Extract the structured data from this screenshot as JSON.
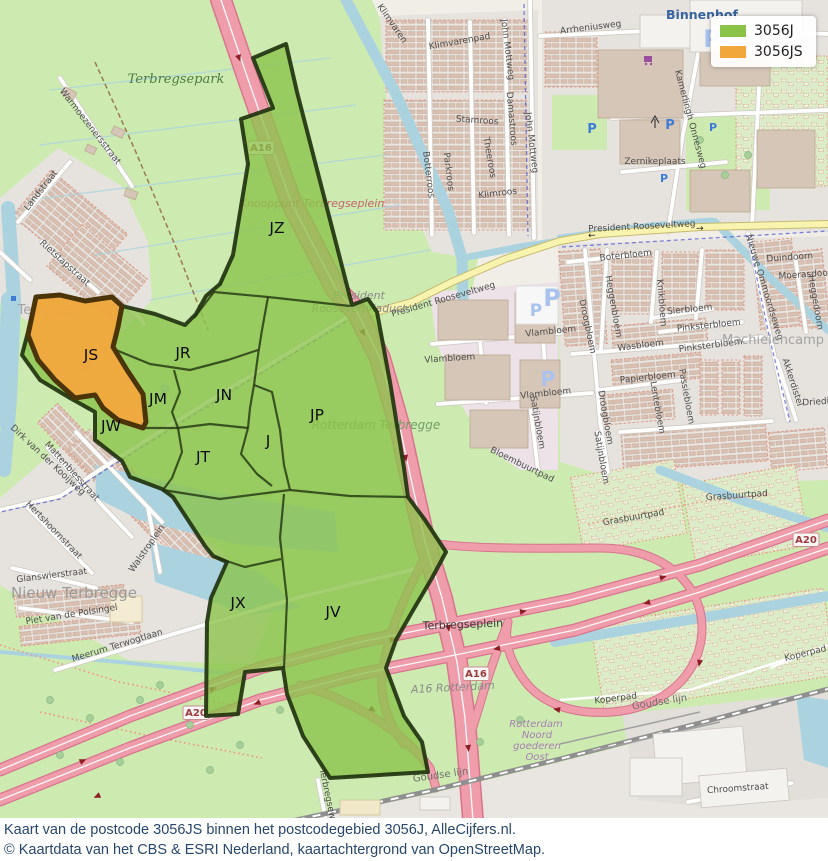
{
  "legend": {
    "items": [
      {
        "label": "3056J",
        "color": "#8bc349",
        "outline": "#223310"
      },
      {
        "label": "3056JS",
        "color": "#f2a73d",
        "outline": "#4a3408"
      }
    ]
  },
  "caption": {
    "line1": "Kaart van de postcode 3056JS binnen het postcodegebied 3056J, AlleCijfers.nl.",
    "line2": "© Kaartdata van het CBS & ESRI Nederland, kaartachtergrond van OpenStreetMap."
  },
  "map": {
    "region_labels": [
      {
        "t": "JZ",
        "x": 277,
        "y": 233
      },
      {
        "t": "JR",
        "x": 183,
        "y": 358
      },
      {
        "t": "JS",
        "x": 91,
        "y": 360
      },
      {
        "t": "JM",
        "x": 158,
        "y": 404
      },
      {
        "t": "JN",
        "x": 224,
        "y": 400
      },
      {
        "t": "JW",
        "x": 111,
        "y": 431
      },
      {
        "t": "JT",
        "x": 203,
        "y": 462
      },
      {
        "t": "J",
        "x": 268,
        "y": 446
      },
      {
        "t": "JP",
        "x": 317,
        "y": 420
      },
      {
        "t": "JX",
        "x": 238,
        "y": 608
      },
      {
        "t": "JV",
        "x": 333,
        "y": 617
      }
    ],
    "road_shields": [
      {
        "t": "A16",
        "x": 476,
        "y": 677
      },
      {
        "t": "A16",
        "x": 261,
        "y": 151
      },
      {
        "t": "A20",
        "x": 806,
        "y": 543
      },
      {
        "t": "A20",
        "x": 196,
        "y": 716
      }
    ],
    "place_labels": [
      {
        "t": "Terbregsepark",
        "x": 176,
        "y": 83,
        "c": "park"
      },
      {
        "t": "Nieuw Terbregge",
        "x": 74,
        "y": 598,
        "c": "suburb"
      },
      {
        "t": "Machielencamp",
        "x": 773,
        "y": 344,
        "c": "suburb2"
      },
      {
        "t": "Terbregge",
        "x": 50,
        "y": 314,
        "c": "suburb2"
      },
      {
        "t": "Binnenhof",
        "x": 702,
        "y": 19,
        "c": "town"
      },
      {
        "t": "Knooppunt Terbregseplein",
        "x": 312,
        "y": 207,
        "c": "junction"
      },
      {
        "t": "Rotterdam Terbregge",
        "x": 376,
        "y": 429,
        "c": "greenit"
      },
      {
        "t": "Terbregseplein",
        "x": 463,
        "y": 628,
        "c": "plain",
        "r": -2
      },
      {
        "t": "A16 Rotterdam",
        "x": 453,
        "y": 691,
        "c": "grayit",
        "r": -3
      },
      {
        "t": "President",
        "x": 359,
        "y": 299,
        "c": "grayit"
      },
      {
        "t": "Rooseveltviaduct",
        "x": 359,
        "y": 312,
        "c": "grayit"
      },
      {
        "t": "Rotterdam",
        "x": 536,
        "y": 727,
        "c": "rail"
      },
      {
        "t": "Noord",
        "x": 537,
        "y": 738,
        "c": "rail"
      },
      {
        "t": "goederen",
        "x": 537,
        "y": 749,
        "c": "rail"
      },
      {
        "t": "Oost",
        "x": 537,
        "y": 760,
        "c": "rail"
      },
      {
        "t": "Goudse lijn",
        "x": 660,
        "y": 705,
        "c": "railgray",
        "r": -9
      },
      {
        "t": "Goudse lijn",
        "x": 441,
        "y": 778,
        "c": "railgray",
        "r": -8
      }
    ],
    "street_labels": [
      {
        "t": "Warmoezenersstraat",
        "x": 88,
        "y": 128,
        "r": 52
      },
      {
        "t": "Landstraat",
        "x": 43,
        "y": 192,
        "r": -52
      },
      {
        "t": "Rietstapstraat",
        "x": 63,
        "y": 265,
        "r": 42
      },
      {
        "t": "De Wurft",
        "x": 76,
        "y": 303,
        "r": 10
      },
      {
        "t": "Dirk van der Kooijweg",
        "x": 46,
        "y": 462,
        "r": 43
      },
      {
        "t": "Mattenbiesstraat",
        "x": 70,
        "y": 473,
        "r": 48
      },
      {
        "t": "Hertshoornstraat",
        "x": 52,
        "y": 532,
        "r": 46
      },
      {
        "t": "Walstroplein",
        "x": 149,
        "y": 550,
        "r": -55
      },
      {
        "t": "Glanswierstraat",
        "x": 52,
        "y": 578,
        "r": -7
      },
      {
        "t": "Piet van de Polsingel",
        "x": 72,
        "y": 617,
        "r": -9
      },
      {
        "t": "Meerum Terwogtlaan",
        "x": 118,
        "y": 648,
        "r": -17
      },
      {
        "t": "Klimvaren",
        "x": 390,
        "y": 25,
        "r": 55
      },
      {
        "t": "Klimvarenpad",
        "x": 460,
        "y": 44,
        "r": -10
      },
      {
        "t": "John Mottweg",
        "x": 505,
        "y": 50,
        "r": 83
      },
      {
        "t": "John Mottweg",
        "x": 529,
        "y": 143,
        "r": 83
      },
      {
        "t": "Arrheniusweg",
        "x": 591,
        "y": 30,
        "r": -7
      },
      {
        "t": "Damastroos",
        "x": 509,
        "y": 119,
        "r": 85
      },
      {
        "t": "Stamroos",
        "x": 477,
        "y": 123,
        "r": 4
      },
      {
        "t": "Theeroos",
        "x": 487,
        "y": 158,
        "r": 80
      },
      {
        "t": "Klimroos",
        "x": 498,
        "y": 196,
        "r": -7
      },
      {
        "t": "Botterroos",
        "x": 426,
        "y": 175,
        "r": 83
      },
      {
        "t": "Parkroos",
        "x": 446,
        "y": 172,
        "r": 83
      },
      {
        "t": "Zernikeplaats",
        "x": 655,
        "y": 164
      },
      {
        "t": "Kamerlingh Onnesweg",
        "x": 688,
        "y": 120,
        "r": 75
      },
      {
        "t": "President Rooseveltweg",
        "x": 642,
        "y": 229,
        "r": -3
      },
      {
        "t": "President Rooseveltweg",
        "x": 444,
        "y": 302,
        "r": -16
      },
      {
        "t": "←",
        "x": 592,
        "y": 238,
        "r": -3,
        "c": "arrow"
      },
      {
        "t": "→",
        "x": 700,
        "y": 231,
        "r": -3,
        "c": "arrow"
      },
      {
        "t": "Boterbloem",
        "x": 626,
        "y": 258,
        "r": -6
      },
      {
        "t": "Heggenbloem",
        "x": 611,
        "y": 307,
        "r": 80
      },
      {
        "t": "Knikbloem",
        "x": 659,
        "y": 303,
        "r": 85
      },
      {
        "t": "Sierbloem",
        "x": 690,
        "y": 312,
        "r": -6
      },
      {
        "t": "Pinksterbloem",
        "x": 709,
        "y": 328,
        "r": -6
      },
      {
        "t": "Pinksterbloem",
        "x": 711,
        "y": 348,
        "r": -7
      },
      {
        "t": "Wasbloem",
        "x": 641,
        "y": 348,
        "r": -7
      },
      {
        "t": "Papierbloem",
        "x": 648,
        "y": 380,
        "r": -6
      },
      {
        "t": "Nieuwe Ommoordseweg",
        "x": 762,
        "y": 288,
        "r": 73
      },
      {
        "t": "Duindoorn",
        "x": 790,
        "y": 260,
        "r": -4
      },
      {
        "t": "Moerasdoorn",
        "x": 808,
        "y": 277,
        "r": -4
      },
      {
        "t": "Heggedoorn",
        "x": 813,
        "y": 303,
        "r": 80
      },
      {
        "t": "Akkerdistel",
        "x": 790,
        "y": 383,
        "r": 72
      },
      {
        "t": "Driedistel",
        "x": 824,
        "y": 404,
        "r": -4
      },
      {
        "t": "Droogbloem",
        "x": 585,
        "y": 327,
        "r": 78
      },
      {
        "t": "Droogbloem",
        "x": 603,
        "y": 418,
        "r": 80
      },
      {
        "t": "Vlambloem",
        "x": 551,
        "y": 334,
        "r": -6
      },
      {
        "t": "Vlambloem",
        "x": 450,
        "y": 361,
        "r": -4
      },
      {
        "t": "Vlambloem",
        "x": 546,
        "y": 396,
        "r": -6
      },
      {
        "t": "Satijnbloem",
        "x": 535,
        "y": 423,
        "r": 80
      },
      {
        "t": "Satijnbloem",
        "x": 599,
        "y": 458,
        "r": 80
      },
      {
        "t": "Lentebloem",
        "x": 655,
        "y": 408,
        "r": 80
      },
      {
        "t": "Passiebloem",
        "x": 684,
        "y": 397,
        "r": 80
      },
      {
        "t": "Bloembuurtpad",
        "x": 521,
        "y": 467,
        "r": 26
      },
      {
        "t": "Grasbuurtpad",
        "x": 737,
        "y": 498,
        "r": -4
      },
      {
        "t": "Grasbuurtpad",
        "x": 634,
        "y": 520,
        "r": -10
      },
      {
        "t": "Koperpad",
        "x": 806,
        "y": 656,
        "r": -14
      },
      {
        "t": "Koperpad",
        "x": 616,
        "y": 701,
        "r": -7
      },
      {
        "t": "Chroomstraat",
        "x": 738,
        "y": 791,
        "r": -4
      },
      {
        "t": "Terbregseweg",
        "x": 326,
        "y": 800,
        "r": 78
      }
    ],
    "parking_icons": [
      {
        "x": 712,
        "y": 47,
        "s": 24,
        "l": 1
      },
      {
        "x": 552,
        "y": 306,
        "s": 24,
        "l": 1
      },
      {
        "x": 536,
        "y": 316,
        "s": 17,
        "l": 1
      },
      {
        "x": 548,
        "y": 386,
        "s": 20,
        "l": 1
      },
      {
        "x": 88,
        "y": 372,
        "s": 15,
        "l": 1
      },
      {
        "x": 165,
        "y": 396,
        "s": 15,
        "l": 1
      },
      {
        "x": 592,
        "y": 133,
        "s": 13
      },
      {
        "x": 670,
        "y": 129,
        "s": 13
      },
      {
        "x": 664,
        "y": 182,
        "s": 11
      },
      {
        "x": 713,
        "y": 131,
        "s": 11
      }
    ]
  }
}
